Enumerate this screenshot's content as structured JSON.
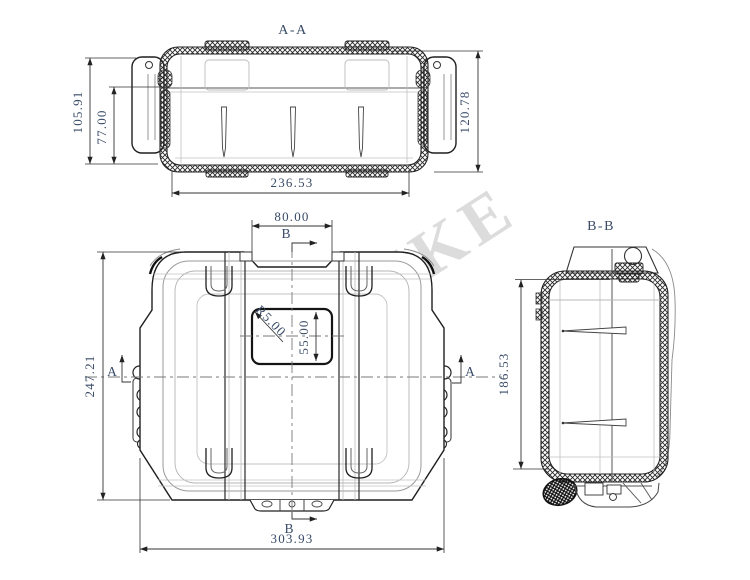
{
  "watermark": {
    "text": "KAXIKE"
  },
  "views": {
    "section_aa": {
      "label": "A-A",
      "dim_total_height": "105.91",
      "dim_inner_height": "77.00",
      "dim_lid_height": "120.78",
      "dim_width": "236.53"
    },
    "front": {
      "marker_b_top": "B",
      "marker_b_bottom": "B",
      "marker_a_left": "A",
      "marker_a_right": "A",
      "dim_top_width": "80.00",
      "dim_height": "247.21",
      "dim_width": "303.93",
      "dim_label_height": "55.00",
      "dim_label_radius": "R5.00"
    },
    "section_bb": {
      "label": "B-B",
      "dim_inner_height": "186.53"
    }
  },
  "colors": {
    "dimension_text": "#3a4c68",
    "line": "#222222",
    "watermark_gray": "#d6d6d6",
    "logo_orange": "#efa23e",
    "logo_cream": "#f5d9ad",
    "logo_cream_light": "#f9e8cd"
  }
}
